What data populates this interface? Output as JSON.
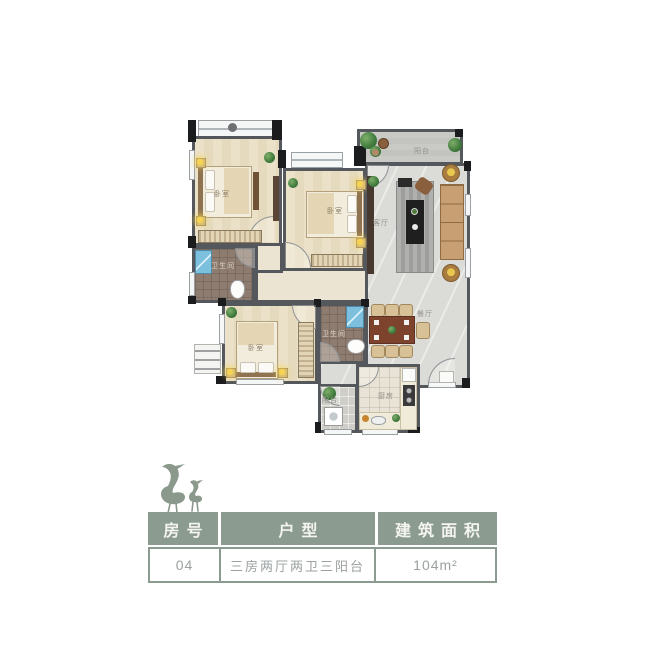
{
  "colors": {
    "accent_sage": "#8C9B90",
    "wall_grey": "#54575B",
    "column_black": "#1B1C1E",
    "wood_floor": "#E8DEC3",
    "marble_floor": "#DBDBD7",
    "bath_tile": "#8D7C6F",
    "value_text": "#9BA0A0",
    "header_text": "#F4F4F1"
  },
  "logo": {
    "icon": "herons-icon"
  },
  "plan": {
    "rooms": [
      {
        "id": "bedroom-top-left",
        "label": "卧室"
      },
      {
        "id": "bedroom-middle",
        "label": "卧室"
      },
      {
        "id": "living-room",
        "label": "客厅"
      },
      {
        "id": "balcony-top",
        "label": "阳台"
      },
      {
        "id": "bathroom-top",
        "label": "卫生间"
      },
      {
        "id": "bedroom-bottom",
        "label": "卧室"
      },
      {
        "id": "bathroom-middle",
        "label": "卫生间"
      },
      {
        "id": "dining-area",
        "label": "餐厅"
      },
      {
        "id": "balcony-service",
        "label": "阳台"
      },
      {
        "id": "kitchen",
        "label": "厨房"
      }
    ]
  },
  "table": {
    "headers": [
      "房号",
      "户型",
      "建筑面积"
    ],
    "row": {
      "room_no": "04",
      "layout": "三房两厅两卫三阳台",
      "area": "104m²"
    }
  }
}
